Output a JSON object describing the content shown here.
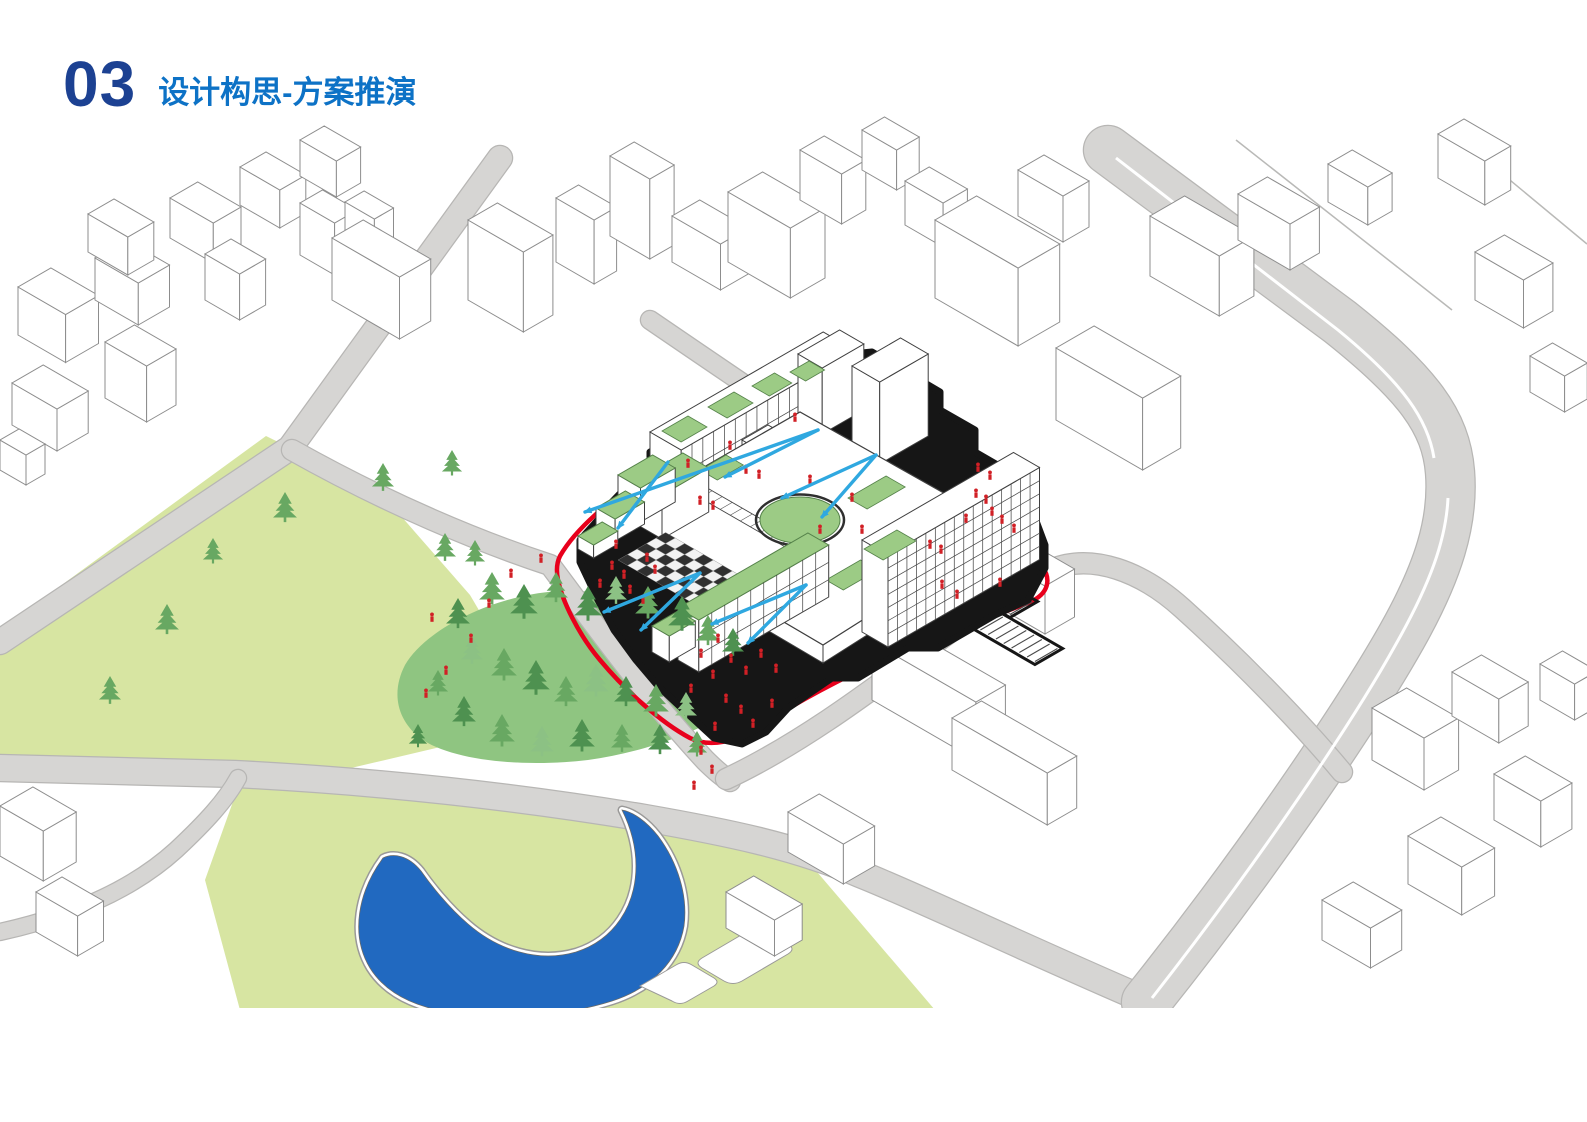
{
  "header": {
    "number": "03",
    "title": "设计构思-方案推演"
  },
  "colors": {
    "number_blue": "#1c4192",
    "title_blue": "#0d72c6",
    "context_fill": "#ffffff",
    "context_stroke": "#8d8d8d",
    "road_fill": "#d6d5d3",
    "road_edge": "#b7b6b4",
    "park_fill": "#d7e5a2",
    "forest_fill": "#8fc581",
    "tree_dark": "#4e9150",
    "tree_mid": "#68a862",
    "tree_light": "#8cc184",
    "lake_fill": "#2169c0",
    "shore_gray": "#9a9998",
    "roof_green": "#9ccb85",
    "roof_green_edge": "#55824a",
    "building_black": "#161616",
    "building_stroke": "#3f3f3f",
    "boundary_red": "#e8001c",
    "arrow_blue": "#2fa8e0",
    "people_red": "#d12026",
    "checker_dark": "#303030",
    "checker_light": "#f2f2f2"
  },
  "scene": {
    "clip_y": 1008,
    "parks": [
      {
        "name": "park-west",
        "d": "M266,436 L380,492 L470,595 L520,680 L470,740 L300,780 L0,765 L0,630 Z"
      },
      {
        "name": "park-lake",
        "d": "M240,782 L540,806 L800,852 L935,1010 L240,1010 L205,880 Z"
      }
    ],
    "forest": {
      "d": "M548,592 C610,585 680,610 718,632 C748,650 760,672 748,692 C730,720 660,750 588,760 C520,768 450,760 420,738 C395,718 392,690 405,665 C425,630 490,598 548,592 Z"
    },
    "roads": [
      {
        "name": "road-northwest",
        "d": "M500,158 L290,448 L0,642",
        "w": 24
      },
      {
        "name": "road-site-west",
        "d": "M292,450 C390,505 480,542 550,565 C595,625 645,695 705,760 C715,770 722,776 730,781",
        "w": 20
      },
      {
        "name": "road-south",
        "d": "M0,768 L235,774 C390,782 525,798 645,818 C725,832 795,846 860,874 C925,900 1015,944 1150,1002",
        "w": 26
      },
      {
        "name": "road-main-east",
        "d": "M1108,150 L1340,322 C1418,384 1446,422 1450,472 C1454,522 1438,572 1402,636 C1358,714 1258,862 1146,1002",
        "w": 48
      },
      {
        "name": "road-site-south",
        "d": "M726,779 C805,742 882,682 942,638 C992,602 1022,582 1050,570 C1092,552 1142,572 1182,608 C1242,662 1302,724 1342,772",
        "w": 20
      },
      {
        "name": "road-site-north",
        "d": "M650,320 C770,402 888,482 1002,554 C1022,566 1036,572 1050,570",
        "w": 18
      },
      {
        "name": "road-southwest",
        "d": "M0,932 C72,916 132,890 176,850 C206,822 226,800 238,778",
        "w": 16
      }
    ],
    "medians": [
      {
        "d": "M1116,158 L1338,330 C1404,384 1428,420 1434,458",
        "w": 3
      },
      {
        "d": "M1448,498 C1446,540 1430,584 1396,644 C1354,720 1260,860 1152,998",
        "w": 3
      }
    ],
    "block_lines": [
      "M1452,132 L1587,244",
      "M1236,140 L1452,310"
    ],
    "lake": {
      "d": "M383,858 C358,892 350,935 370,968 C385,992 412,1006 448,1012 C505,1020 565,1016 612,1001 C652,988 678,961 684,926 C688,896 678,863 658,836 C646,821 633,812 622,810 C630,826 636,846 636,866 C636,906 614,940 576,952 C538,963 498,950 468,924 C448,907 430,884 421,871 C408,855 393,853 383,858 Z"
    },
    "plazas": [
      "M702,958 L748,931 Q757,926 766,931 L788,944 Q796,949 788,954 L742,981 Q733,986 724,981 L702,968 Q694,963 702,958 Z",
      "M640,986 L676,965 Q684,960 692,965 L714,978 Q720,982 714,986 L688,1001 Q680,1006 672,1001 Z"
    ],
    "context_buildings": [
      {
        "o": [
          18,
          335
        ],
        "a": 55,
        "b": 38,
        "h": 48
      },
      {
        "o": [
          95,
          300
        ],
        "a": 50,
        "b": 36,
        "h": 42
      },
      {
        "o": [
          88,
          252
        ],
        "a": 46,
        "b": 30,
        "h": 38
      },
      {
        "o": [
          170,
          238
        ],
        "a": 50,
        "b": 32,
        "h": 40
      },
      {
        "o": [
          240,
          205
        ],
        "a": 46,
        "b": 30,
        "h": 38
      },
      {
        "o": [
          300,
          176
        ],
        "a": 42,
        "b": 28,
        "h": 36
      },
      {
        "o": [
          300,
          255
        ],
        "a": 40,
        "b": 26,
        "h": 52
      },
      {
        "o": [
          345,
          232
        ],
        "a": 34,
        "b": 22,
        "h": 30
      },
      {
        "o": [
          12,
          425
        ],
        "a": 52,
        "b": 36,
        "h": 42
      },
      {
        "o": [
          105,
          398
        ],
        "a": 48,
        "b": 34,
        "h": 56
      },
      {
        "o": [
          0,
          470
        ],
        "a": 30,
        "b": 22,
        "h": 30
      },
      {
        "o": [
          332,
          300
        ],
        "a": 78,
        "b": 36,
        "h": 62
      },
      {
        "o": [
          205,
          300
        ],
        "a": 40,
        "b": 30,
        "h": 46
      },
      {
        "o": [
          468,
          300
        ],
        "a": 64,
        "b": 34,
        "h": 80
      },
      {
        "o": [
          556,
          262
        ],
        "a": 44,
        "b": 26,
        "h": 64
      },
      {
        "o": [
          610,
          236
        ],
        "a": 46,
        "b": 28,
        "h": 80
      },
      {
        "o": [
          672,
          262
        ],
        "a": 56,
        "b": 32,
        "h": 46
      },
      {
        "o": [
          728,
          262
        ],
        "a": 72,
        "b": 40,
        "h": 70
      },
      {
        "o": [
          800,
          200
        ],
        "a": 48,
        "b": 28,
        "h": 50
      },
      {
        "o": [
          862,
          170
        ],
        "a": 40,
        "b": 26,
        "h": 40
      },
      {
        "o": [
          905,
          225
        ],
        "a": 44,
        "b": 28,
        "h": 44
      },
      {
        "o": [
          935,
          298
        ],
        "a": 96,
        "b": 48,
        "h": 78
      },
      {
        "o": [
          1018,
          216
        ],
        "a": 52,
        "b": 30,
        "h": 46
      },
      {
        "o": [
          1150,
          276
        ],
        "a": 80,
        "b": 40,
        "h": 60
      },
      {
        "o": [
          1238,
          240
        ],
        "a": 60,
        "b": 34,
        "h": 46
      },
      {
        "o": [
          1328,
          202
        ],
        "a": 46,
        "b": 28,
        "h": 38
      },
      {
        "o": [
          1438,
          178
        ],
        "a": 54,
        "b": 30,
        "h": 44
      },
      {
        "o": [
          1056,
          420
        ],
        "a": 100,
        "b": 44,
        "h": 72
      },
      {
        "o": [
          1475,
          300
        ],
        "a": 56,
        "b": 34,
        "h": 48
      },
      {
        "o": [
          1530,
          392
        ],
        "a": 40,
        "b": 26,
        "h": 36
      },
      {
        "o": [
          872,
          700
        ],
        "a": 120,
        "b": 34,
        "h": 58
      },
      {
        "o": [
          952,
          770
        ],
        "a": 110,
        "b": 34,
        "h": 52
      },
      {
        "o": [
          1000,
          608
        ],
        "a": 52,
        "b": 34,
        "h": 48
      },
      {
        "o": [
          788,
          852
        ],
        "a": 64,
        "b": 36,
        "h": 40
      },
      {
        "o": [
          726,
          928
        ],
        "a": 56,
        "b": 32,
        "h": 36
      },
      {
        "o": [
          1372,
          760
        ],
        "a": 60,
        "b": 40,
        "h": 52
      },
      {
        "o": [
          1452,
          716
        ],
        "a": 54,
        "b": 34,
        "h": 44
      },
      {
        "o": [
          1494,
          820
        ],
        "a": 54,
        "b": 36,
        "h": 46
      },
      {
        "o": [
          1408,
          884
        ],
        "a": 62,
        "b": 38,
        "h": 48
      },
      {
        "o": [
          1322,
          940
        ],
        "a": 56,
        "b": 36,
        "h": 40
      },
      {
        "o": [
          1540,
          700
        ],
        "a": 40,
        "b": 26,
        "h": 36
      },
      {
        "o": [
          0,
          856
        ],
        "a": 50,
        "b": 38,
        "h": 50
      },
      {
        "o": [
          36,
          932
        ],
        "a": 48,
        "b": 30,
        "h": 40
      }
    ],
    "boundary_red": "M560,556 C575,530 610,498 650,476 C700,448 760,434 820,440 C870,445 930,470 968,505 C1000,535 1030,552 1042,566 C1052,580 1048,594 1030,602 C980,622 940,634 900,652 C850,674 800,700 760,726 C735,742 710,748 690,738 C660,722 625,690 600,660 C578,634 562,600 558,580 C556,570 557,562 560,556 Z",
    "site_black": "M592,556 C610,530 640,508 676,490 C720,468 770,458 818,462 C862,466 912,486 952,518 C985,545 1012,562 1030,574 C1040,582 1036,592 1020,598 C975,614 935,625 895,643 C850,663 805,684 768,708 C746,722 724,726 706,716 C680,700 650,672 626,644 C606,620 594,592 590,574 C588,566 589,561 592,556 Z",
    "scurve": "M700,712 C740,700 762,682 776,661 C791,640 812,628 841,622 C866,617 881,606 889,592",
    "parking": {
      "rows": [
        {
          "o": [
            893,
            547
          ],
          "n": 15,
          "step": 9,
          "len": 26
        },
        {
          "o": [
            918,
            594
          ],
          "n": 15,
          "step": 9,
          "len": 26
        }
      ]
    },
    "building": {
      "silhouette": "M580,562 L580,540 L598,520 L612,520 L612,502 L636,477 L650,470 L650,452 L700,424 L714,430 L714,414 L796,366 L812,374 L812,358 L872,352 L940,392 L940,410 L975,430 L975,452 L1020,478 L1045,545 L1045,568 L1028,600 L995,615 L938,648 L908,648 L858,678 L832,678 L788,708 L766,732 L742,744 L714,738 L688,714 L658,686 L636,660 L614,630 L598,600 Z",
      "deck": {
        "top": [
          [
            655,
            495
          ],
          [
            800,
            412
          ],
          [
            965,
            505
          ],
          [
            965,
            555
          ],
          [
            823,
            645
          ],
          [
            658,
            548
          ]
        ],
        "h": 18
      },
      "back_boxes": [
        {
          "o": [
            650,
            480
          ],
          "a": 36,
          "b": 200,
          "h": 48,
          "grid": [
            16,
            2
          ]
        },
        {
          "o": [
            798,
            420
          ],
          "a": 28,
          "b": 48,
          "h": 66
        },
        {
          "o": [
            852,
            448
          ],
          "a": 32,
          "b": 56,
          "h": 82
        },
        {
          "o": [
            742,
            470
          ],
          "a": 22,
          "b": 30,
          "h": 30
        }
      ],
      "front_boxes": [
        {
          "o": [
            636,
            524
          ],
          "a": 30,
          "b": 54,
          "h": 44,
          "roof": "green"
        },
        {
          "o": [
            618,
            509
          ],
          "a": 26,
          "b": 40,
          "h": 34,
          "roof": "green"
        },
        {
          "o": [
            596,
            530
          ],
          "a": 22,
          "b": 34,
          "h": 22,
          "roof": "green"
        },
        {
          "o": [
            578,
            549
          ],
          "a": 18,
          "b": 28,
          "h": 13,
          "roof": "green"
        }
      ],
      "east_slab": {
        "o": [
          862,
          632
        ],
        "a": 30,
        "b": 175,
        "h": 92,
        "grid": [
          16,
          7
        ]
      },
      "south_boxes": [
        {
          "o": [
            678,
            660
          ],
          "a": 24,
          "b": 150,
          "h": 52,
          "roof": "green",
          "grid": [
            10,
            3
          ]
        },
        {
          "o": [
            652,
            652
          ],
          "a": 20,
          "b": 30,
          "h": 26,
          "roof": "green"
        }
      ],
      "patches": [
        [
          662,
          431,
          22,
          30
        ],
        [
          708,
          407,
          22,
          30
        ],
        [
          752,
          386,
          20,
          26
        ],
        [
          790,
          372,
          18,
          22
        ],
        [
          848,
          498,
          22,
          44
        ],
        [
          826,
          580,
          20,
          40
        ],
        [
          700,
          470,
          20,
          30
        ]
      ],
      "slab_patches": [
        [
          864,
          549,
          22,
          38
        ]
      ],
      "lawn": {
        "cx": 800,
        "cy": 520,
        "rx": 40,
        "ry": 23
      },
      "skylights": [
        {
          "o": [
            690,
            492
          ],
          "a": 116,
          "b": 14,
          "n": 10
        },
        {
          "o": [
            982,
            563
          ],
          "a": 20,
          "b": 40,
          "n": 7
        }
      ],
      "checker": {
        "o": [
          618,
          560
        ],
        "cell": 11,
        "cols": 8,
        "rows": 5
      }
    },
    "trees_park": [
      [
        167,
        630,
        26
      ],
      [
        285,
        518,
        26
      ],
      [
        383,
        487,
        24
      ],
      [
        445,
        557,
        24
      ],
      [
        452,
        472,
        22
      ],
      [
        475,
        562,
        22
      ],
      [
        213,
        560,
        22
      ],
      [
        110,
        700,
        24
      ]
    ],
    "trees_forest": [
      [
        458,
        624,
        26,
        0
      ],
      [
        492,
        600,
        28,
        1
      ],
      [
        524,
        614,
        30,
        0
      ],
      [
        556,
        598,
        26,
        1
      ],
      [
        588,
        616,
        30,
        0
      ],
      [
        616,
        600,
        24,
        2
      ],
      [
        648,
        614,
        28,
        1
      ],
      [
        682,
        626,
        30,
        0
      ],
      [
        708,
        641,
        26,
        1
      ],
      [
        733,
        652,
        24,
        0
      ],
      [
        472,
        660,
        24,
        2
      ],
      [
        504,
        676,
        28,
        1
      ],
      [
        536,
        690,
        30,
        0
      ],
      [
        566,
        702,
        26,
        1
      ],
      [
        596,
        692,
        28,
        2
      ],
      [
        626,
        702,
        26,
        0
      ],
      [
        656,
        712,
        28,
        1
      ],
      [
        686,
        716,
        24,
        2
      ],
      [
        438,
        692,
        22,
        1
      ],
      [
        464,
        722,
        26,
        0
      ],
      [
        502,
        742,
        28,
        1
      ],
      [
        542,
        752,
        26,
        2
      ],
      [
        582,
        747,
        28,
        0
      ],
      [
        622,
        748,
        24,
        1
      ],
      [
        660,
        750,
        26,
        0
      ],
      [
        697,
        753,
        22,
        1
      ],
      [
        418,
        744,
        20,
        0
      ]
    ],
    "people": [
      [
        612,
        568
      ],
      [
        624,
        577
      ],
      [
        600,
        586
      ],
      [
        630,
        592
      ],
      [
        643,
        602
      ],
      [
        616,
        547
      ],
      [
        655,
        572
      ],
      [
        647,
        560
      ],
      [
        511,
        576
      ],
      [
        489,
        606
      ],
      [
        471,
        641
      ],
      [
        446,
        673
      ],
      [
        426,
        696
      ],
      [
        541,
        561
      ],
      [
        432,
        620
      ],
      [
        718,
        641
      ],
      [
        701,
        656
      ],
      [
        731,
        661
      ],
      [
        746,
        673
      ],
      [
        713,
        677
      ],
      [
        691,
        691
      ],
      [
        726,
        701
      ],
      [
        761,
        656
      ],
      [
        776,
        671
      ],
      [
        741,
        712
      ],
      [
        753,
        726
      ],
      [
        715,
        729
      ],
      [
        772,
        706
      ],
      [
        700,
        503
      ],
      [
        713,
        508
      ],
      [
        746,
        472
      ],
      [
        759,
        477
      ],
      [
        810,
        482
      ],
      [
        862,
        532
      ],
      [
        688,
        466
      ],
      [
        730,
        448
      ],
      [
        795,
        420
      ],
      [
        852,
        500
      ],
      [
        820,
        532
      ],
      [
        976,
        496
      ],
      [
        986,
        502
      ],
      [
        992,
        514
      ],
      [
        1002,
        522
      ],
      [
        1014,
        531
      ],
      [
        966,
        521
      ],
      [
        942,
        587
      ],
      [
        957,
        597
      ],
      [
        1000,
        585
      ],
      [
        930,
        547
      ],
      [
        941,
        552
      ],
      [
        978,
        470
      ],
      [
        990,
        478
      ],
      [
        701,
        753
      ],
      [
        694,
        788
      ],
      [
        712,
        772
      ]
    ],
    "arrows": [
      [
        818,
        430,
        585,
        512
      ],
      [
        818,
        430,
        725,
        477
      ],
      [
        876,
        455,
        782,
        498
      ],
      [
        876,
        455,
        822,
        517
      ],
      [
        668,
        462,
        618,
        528
      ],
      [
        700,
        573,
        604,
        612
      ],
      [
        700,
        573,
        641,
        630
      ],
      [
        806,
        585,
        712,
        624
      ],
      [
        806,
        585,
        748,
        643
      ]
    ]
  }
}
